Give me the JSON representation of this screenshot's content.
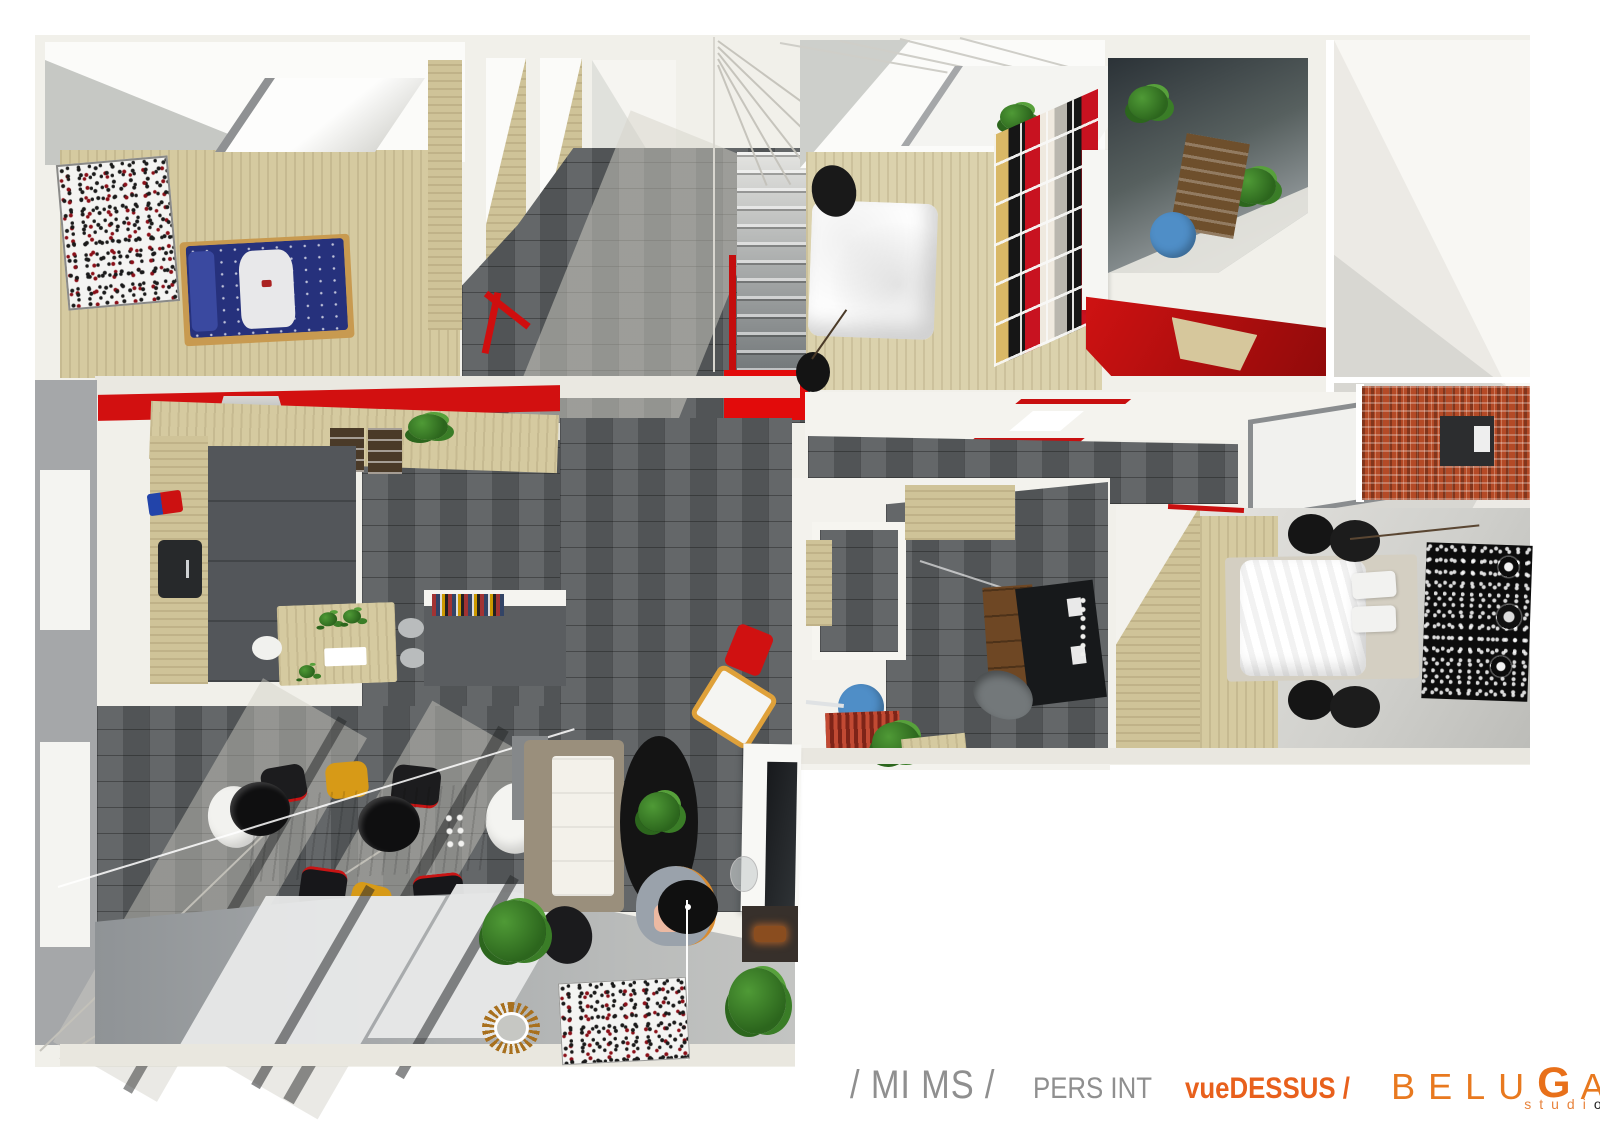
{
  "canvas": {
    "width": 1600,
    "height": 1131,
    "background": "#ffffff"
  },
  "colors": {
    "accent_red": "#d21010",
    "brand_orange": "#e8701a",
    "caption_gray": "#8f8f8f",
    "floor_tile_gray": "#5a5e60",
    "wood_light": "#d5caa0",
    "brick_red": "#b44a26",
    "washbasin_blue": "#4f8ec7",
    "duvet_navy": "#26317c",
    "chair_yellow": "#d79a17"
  },
  "caption": {
    "project_code": "/ MI MS /",
    "category": "PERS INT",
    "view": "vueDESSUS /",
    "brand_pre": "BELU",
    "brand_g": "G",
    "brand_post": "A",
    "studio_text": "studi",
    "studio_o": "o"
  }
}
